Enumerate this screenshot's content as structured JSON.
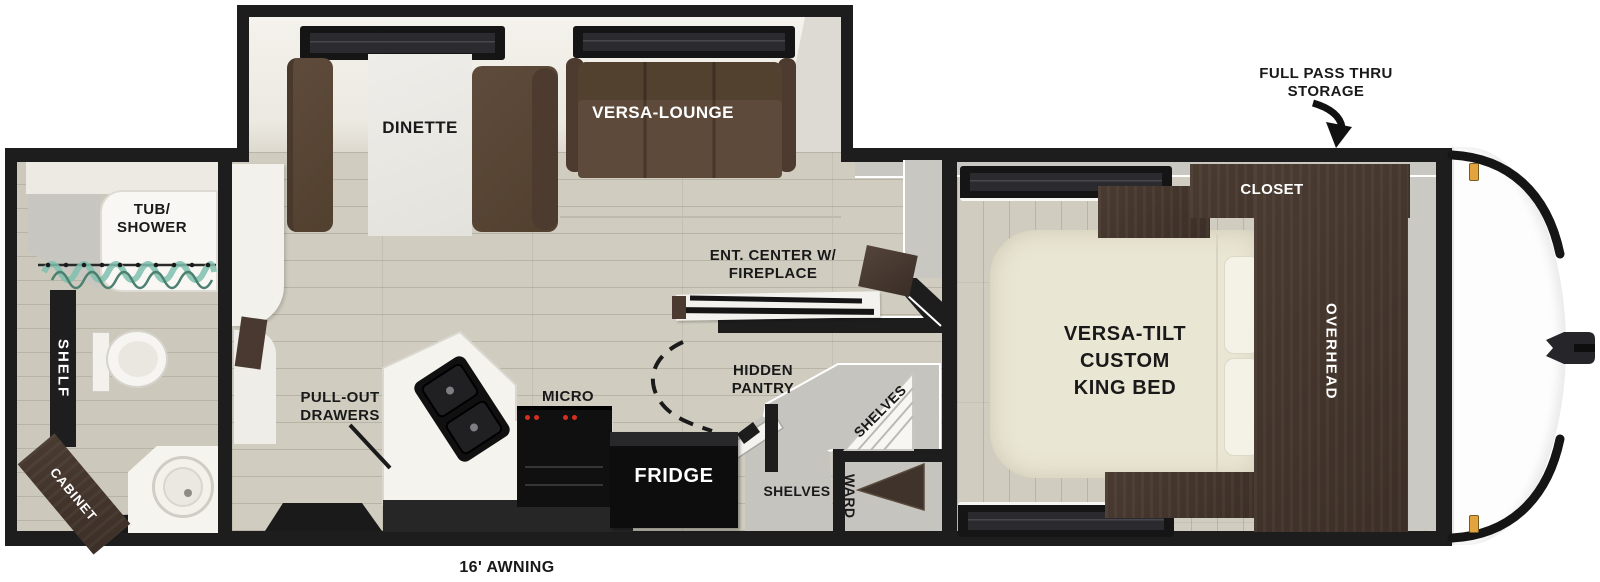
{
  "callouts": {
    "storage_line1": "FULL PASS THRU",
    "storage_line2": "STORAGE",
    "awning": "16' AWNING"
  },
  "bedroom": {
    "closet": "CLOSET",
    "overhead": "OVERHEAD",
    "bed_line1": "VERSA-TILT",
    "bed_line2": "CUSTOM",
    "bed_line3": "KING BED"
  },
  "living": {
    "dinette": "DINETTE",
    "lounge": "VERSA-LOUNGE",
    "ent_line1": "ENT. CENTER W/",
    "ent_line2": "FIREPLACE"
  },
  "kitchen": {
    "micro": "MICRO",
    "fridge": "FRIDGE",
    "pullout_line1": "PULL-OUT",
    "pullout_line2": "DRAWERS",
    "pantry_line1": "HIDDEN",
    "pantry_line2": "PANTRY",
    "pantry_shelves": "SHELVES",
    "alcove_shelves": "SHELVES",
    "wardrobe": "WARD"
  },
  "bathroom": {
    "tub_line1": "TUB/",
    "tub_line2": "SHOWER",
    "shelf": "SHELF",
    "cabinet": "CABINET"
  },
  "colors": {
    "wall": "#1d1d1d",
    "floor": "#d0cdc0",
    "sofa_brown": "#5a4738",
    "cabinet_brown": "#44362e",
    "bed_cream": "#e9e5d3",
    "appliance_black": "#141414",
    "marker_amber": "#e2a43f",
    "curtain_teal": "#7ec0ae"
  }
}
